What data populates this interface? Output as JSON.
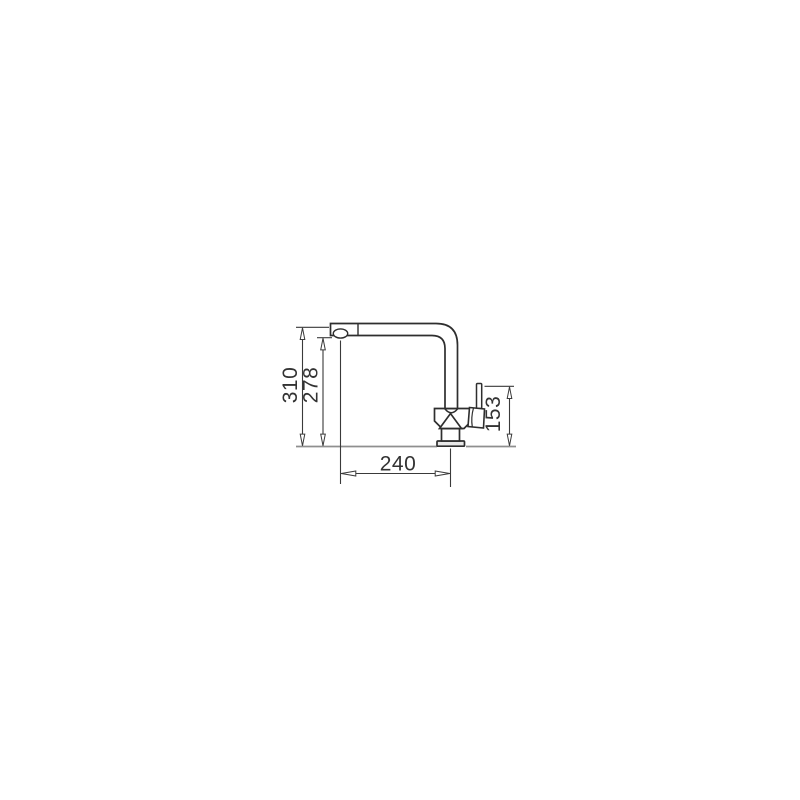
{
  "drawing": {
    "subject": "kitchen-faucet-side-view",
    "dimensions": {
      "total_height": "310",
      "spout_underside_height": "278",
      "spout_reach": "240",
      "handle_top_height": "153"
    },
    "colors": {
      "background": "#ffffff",
      "outline": "#2e2e2e",
      "dimension_line": "#3a3a3a",
      "text": "#333333",
      "counter_line": "#8f8f8f"
    }
  }
}
